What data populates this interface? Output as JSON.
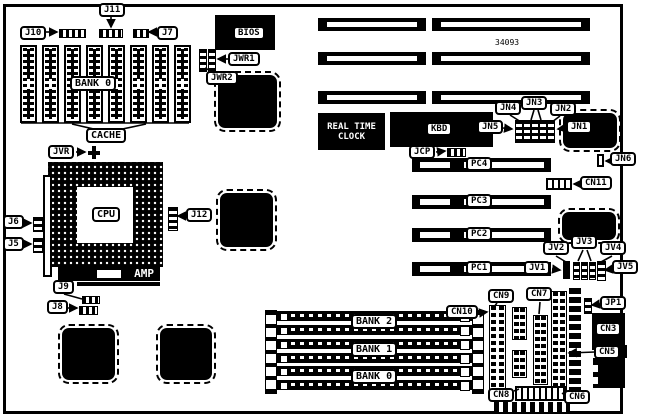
{
  "board": {
    "part_number": "34093",
    "chips": {
      "bios": "BIOS",
      "rtc_line1": "REAL TIME",
      "rtc_line2": "CLOCK",
      "kbd": "KBD",
      "cpu": "CPU",
      "amp": "AMP"
    },
    "cache_area": {
      "bank_label": "BANK 0",
      "cache_label": "CACHE"
    },
    "simm_banks": {
      "bank2": "BANK 2",
      "bank1": "BANK 1",
      "bank0": "BANK 0"
    },
    "pc_slots": {
      "pc4": "PC4",
      "pc3": "PC3",
      "pc2": "PC2",
      "pc1": "PC1"
    },
    "jumpers": {
      "j10": "J10",
      "j11": "J11",
      "j7": "J7",
      "jwr1": "JWR1",
      "jwr2": "JWR2",
      "jvr": "JVR",
      "j6": "J6",
      "j5": "J5",
      "j12": "J12",
      "j9": "J9",
      "j8": "J8",
      "jcp": "JCP",
      "jn1": "JN1",
      "jn2": "JN2",
      "jn3": "JN3",
      "jn4": "JN4",
      "jn5": "JN5",
      "jn6": "JN6",
      "jv1": "JV1",
      "jv2": "JV2",
      "jv3": "JV3",
      "jv4": "JV4",
      "jv5": "JV5",
      "jp1": "JP1"
    },
    "connectors": {
      "cn3": "CN3",
      "cn5": "CN5",
      "cn6": "CN6",
      "cn7": "CN7",
      "cn8": "CN8",
      "cn9": "CN9",
      "cn10": "CN10",
      "cn11": "CN11"
    },
    "colors": {
      "ink": "#000000",
      "paper": "#ffffff"
    }
  }
}
